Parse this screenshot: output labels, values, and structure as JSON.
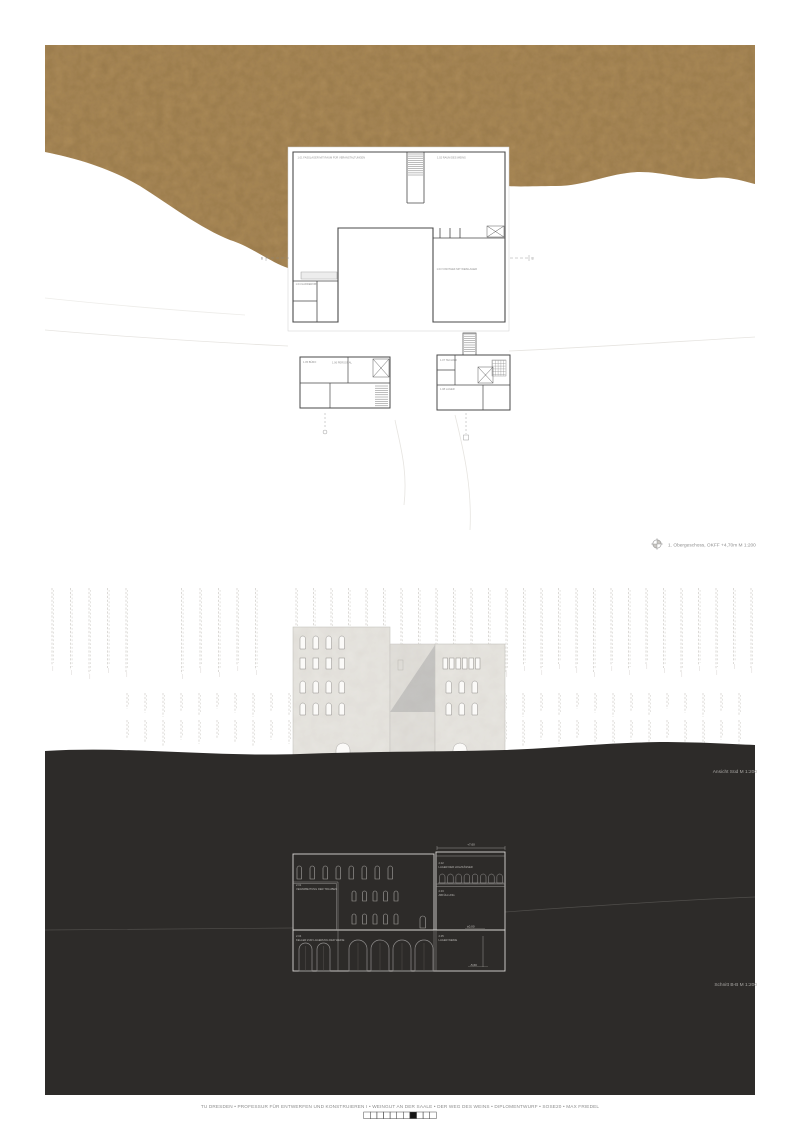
{
  "colors": {
    "page_bg": "#ffffff",
    "terrain": "#ab8a58",
    "terrain_mottle": "#7a5f35",
    "dark_band": "#2d2b29",
    "facade": "#e9e7e2",
    "facade_recess": "#e3e1dc",
    "facade_shadow": "#c6c5c3",
    "window_fill": "#fbfaf8",
    "plan_wall": "#4a4a4a",
    "section_line": "#d8d6d3",
    "section_line_light": "#9a9896",
    "vine": "#d9d7d3",
    "contour": "#e6e4e0"
  },
  "plan": {
    "scale_label": "1. Obergeschoss, OKFF +4,70m M 1:200",
    "section_marker": "B",
    "rooms": [
      {
        "label": "1.01 FASSLAGER MIT RAUM FÜR VERANSTALTUNGEN"
      },
      {
        "label": "1.02 RAUM DES WEINS"
      },
      {
        "label": "1.03 VINOTHEK MIT WEINLAGER"
      },
      {
        "label": "1.04 GARDEROBE"
      },
      {
        "label": "1.05 BÜRO"
      },
      {
        "label": "1.06 PERSONAL"
      },
      {
        "label": "1.07 TECHNIK"
      },
      {
        "label": "1.08 LAGER"
      }
    ]
  },
  "elevation": {
    "label": "Ansicht Süd M 1:200",
    "vineyard_groups": [
      {
        "x_start": 52,
        "x_end": 268,
        "step": 18.5,
        "y": 589,
        "h": 82,
        "tail": true,
        "skip_from": 128,
        "skip_to": 180
      },
      {
        "x_start": 296,
        "x_end": 753,
        "step": 17.5,
        "y": 589,
        "h": 80,
        "tail": true
      },
      {
        "x_start": 127,
        "x_end": 753,
        "step": 18,
        "y": 694,
        "h": 20,
        "tail": false
      },
      {
        "x_start": 127,
        "x_end": 753,
        "step": 18,
        "y": 721,
        "h": 22,
        "tail": false
      }
    ]
  },
  "section": {
    "label": "Schnitt B-B M 1:200",
    "rooms": [
      {
        "id": "2.01",
        "name": "VERARBEITUNG DER TRAUBEN"
      },
      {
        "id": "2.02",
        "name": "LAGER DER HOLZFÄSSER"
      },
      {
        "id": "2.03",
        "name": "ABFÜLLUNG"
      },
      {
        "id": "2.04",
        "name": "KELLER ZUR LAGERUNG DER WEINE"
      },
      {
        "id": "2.05",
        "name": "LAGER WEINE"
      }
    ],
    "levels": [
      {
        "value": "+7,60"
      },
      {
        "value": "±0,00"
      },
      {
        "value": "-5,60"
      }
    ]
  },
  "footer": {
    "text": "TU DRESDEN • PROFESSUR FÜR ENTWERFEN UND KONSTRUIEREN I • WEINGUT AN DER SAALE • DER WEG DES WEINS • DIPLOMENTWURF • SOSE20 • MAX FRIEDEL",
    "pages_total": 11,
    "active_page_index": 7
  }
}
